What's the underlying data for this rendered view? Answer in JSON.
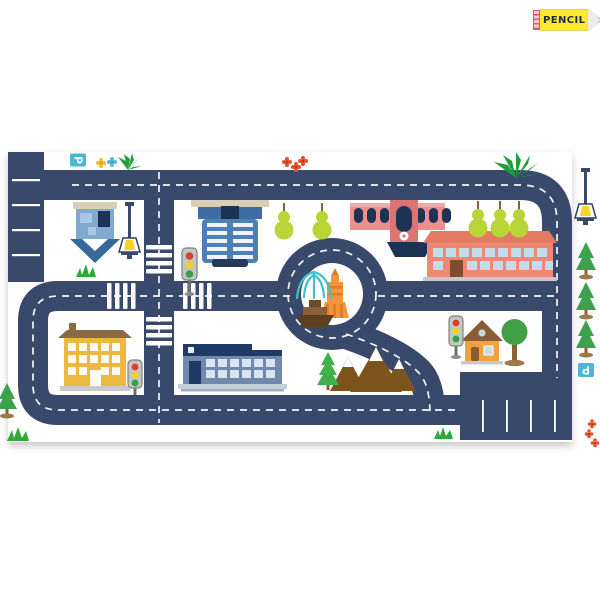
{
  "badge": {
    "label": "PENCIL"
  },
  "signs": {
    "parking_top_left": "P",
    "parking_bottom_right": "P"
  },
  "palette": {
    "road": "#38496B",
    "pine": "#3CA04C",
    "lime": "#B8D437",
    "grassGreen": "#2FA93C",
    "fern": "#1F9E3E",
    "trunk": "#8A6134",
    "mound": "#9B7B4A",
    "towerBlue": "#4E7FB5",
    "navyDark": "#1D3356",
    "stationPink": "#EE8F8F",
    "stationPinkDark": "#DD7474",
    "coral": "#EF8971",
    "coralRoof": "#E57A63",
    "windowBlue": "#C3DCEA",
    "amber": "#ECB83F",
    "amberRoof": "#8A6A43",
    "officeBlue": "#7089AD",
    "officeNavy": "#1F3A66",
    "officeWindow": "#D9E6F0",
    "mountainBrown": "#7C541C",
    "orangeTower": "#F2953C",
    "orangeDark": "#DE7F26",
    "waterTeal": "#3FC1C9",
    "boatHull": "#5E3E1F",
    "boatCabin": "#8A6134",
    "boatDark": "#6B4A28",
    "signBlue": "#4DB6D6",
    "lightRed": "#E03C2E",
    "lightYellow": "#F2D12C",
    "lightGreen": "#35A04A",
    "lampYellow": "#F5D428",
    "roofBeige": "#D9CFB4",
    "baseGray": "#C9C9C9",
    "flowerRed": "#E8502B",
    "flowerRedCenter": "#B5371C",
    "flowerYellow": "#F0C030",
    "flowerTeal": "#58B7D8",
    "roundTree": "#43A047",
    "houseOrange": "#F0A33C",
    "houseRoof": "#8A5C33",
    "houseBlue": "#7FA9CD",
    "houseBlueDark": "#37699B",
    "pencilYellow": "#FFE92A",
    "pencilText": "#1B2B4A",
    "pencilTip": "#ECECEC",
    "pencilEraser": "#F7CBD6",
    "eraserStripe": "#E4556E"
  }
}
